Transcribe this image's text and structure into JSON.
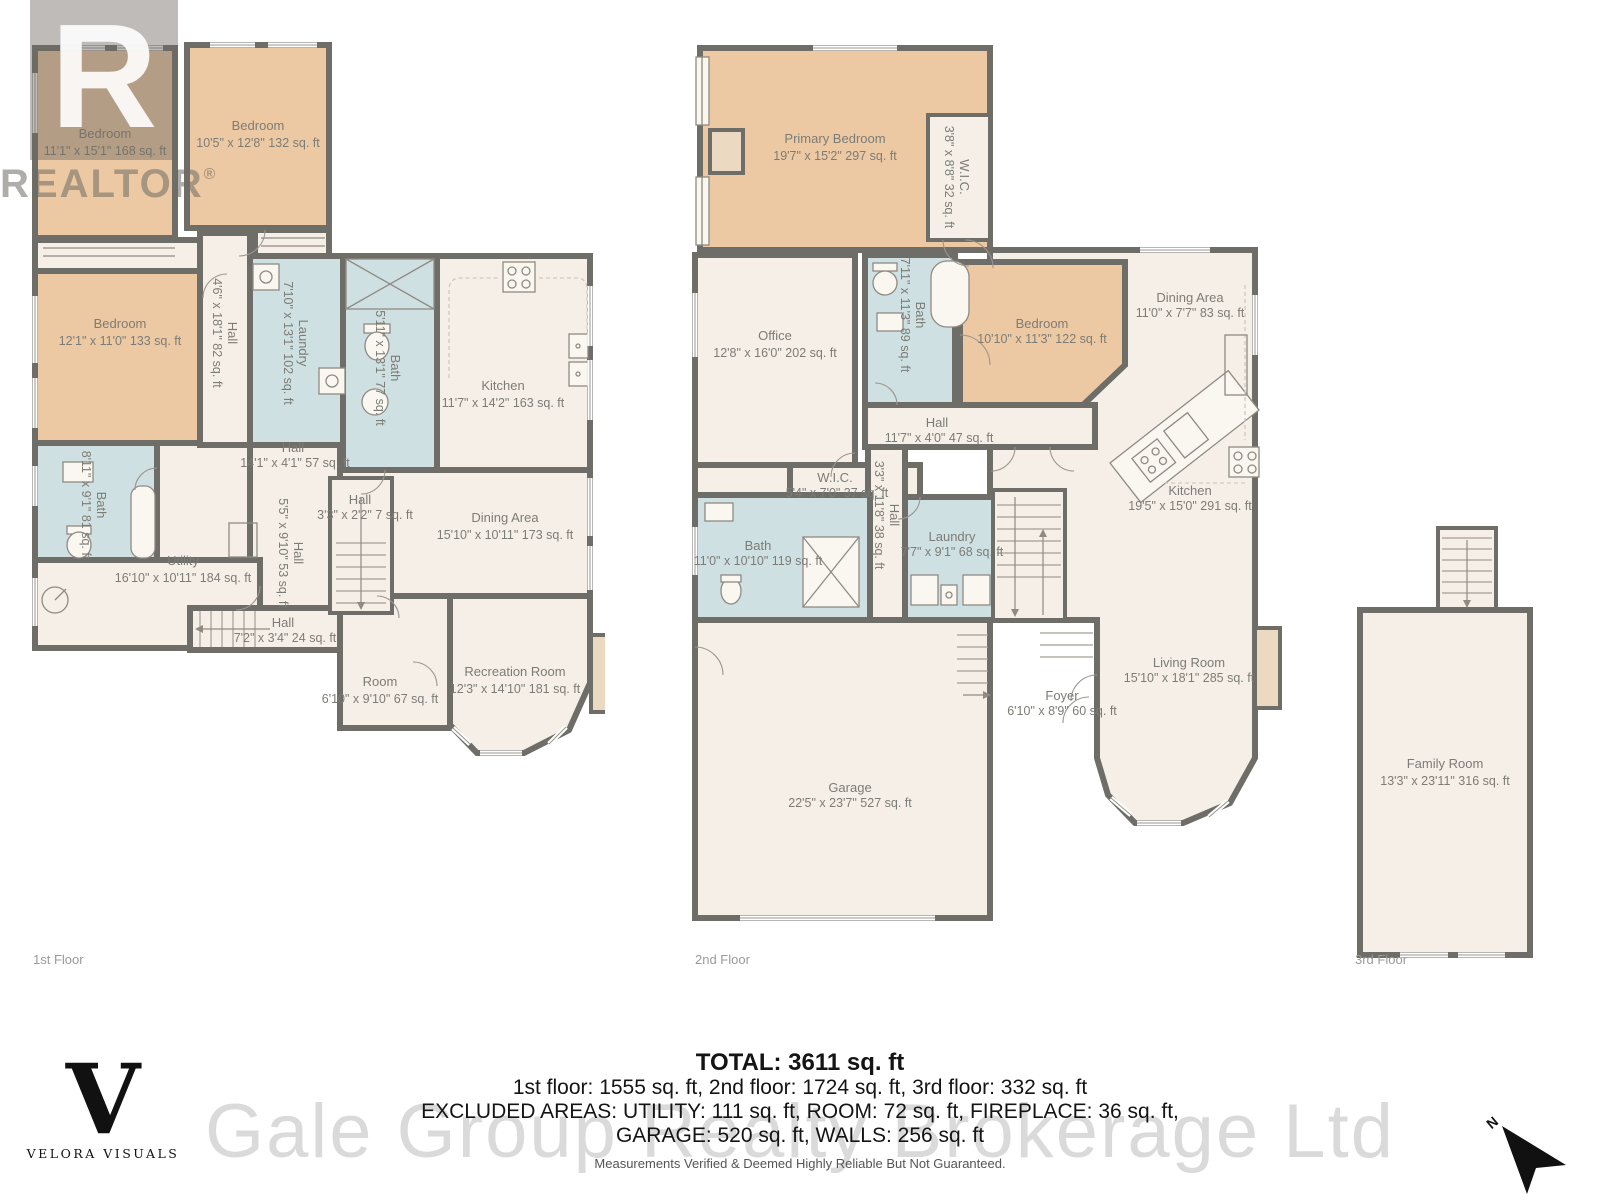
{
  "colors": {
    "bedroom": "#ecc9a3",
    "wet": "#cfe0e3",
    "floor": "#f6efe8",
    "wall": "#6e6d68",
    "label": "#7c7c76"
  },
  "branding": {
    "realtor_glyph": "R",
    "realtor_wordmark": "REALTOR",
    "realtor_reg": "®",
    "velora_initial": "V",
    "velora_name": "VELORA VISUALS",
    "compass_n": "N"
  },
  "floors": [
    {
      "label": "1st Floor",
      "rooms": [
        {
          "name": "Bedroom",
          "dims": "11'1\" x 15'1\" 168 sq. ft"
        },
        {
          "name": "Bedroom",
          "dims": "10'5\" x 12'8\" 132 sq. ft"
        },
        {
          "name": "Bedroom",
          "dims": "12'1\" x 11'0\" 133 sq. ft"
        },
        {
          "name": "Hall",
          "dims": "4'6\" x 18'1\" 82 sq. ft"
        },
        {
          "name": "Laundry",
          "dims": "7'10\" x 13'1\" 102 sq. ft"
        },
        {
          "name": "Bath",
          "dims": "5'11\" x 13'1\" 77 sq. ft"
        },
        {
          "name": "Kitchen",
          "dims": "11'7\" x 14'2\" 163 sq. ft"
        },
        {
          "name": "Bath",
          "dims": "8'11\" x 9'1\" 81 sq. ft"
        },
        {
          "name": "Hall",
          "dims": "14'1\" x 4'1\" 57 sq. ft"
        },
        {
          "name": "Utility",
          "dims": "16'10\" x 10'11\" 184 sq. ft"
        },
        {
          "name": "Hall",
          "dims": "5'5\" x 9'10\" 53 sq. ft"
        },
        {
          "name": "Hall",
          "dims": "3'3\" x 2'2\" 7 sq. ft"
        },
        {
          "name": "Hall",
          "dims": "7'2\" x 3'4\" 24 sq. ft"
        },
        {
          "name": "Room",
          "dims": "6'10\" x 9'10\" 67 sq. ft"
        },
        {
          "name": "Dining Area",
          "dims": "15'10\" x 10'11\" 173 sq. ft"
        },
        {
          "name": "Recreation Room",
          "dims": "12'3\" x 14'10\" 181 sq. ft"
        }
      ]
    },
    {
      "label": "2nd Floor",
      "rooms": [
        {
          "name": "Primary Bedroom",
          "dims": "19'7\" x 15'2\" 297 sq. ft"
        },
        {
          "name": "W.I.C.",
          "dims": "3'8\" x 8'8\" 32 sq. ft"
        },
        {
          "name": "Office",
          "dims": "12'8\" x 16'0\" 202 sq. ft"
        },
        {
          "name": "Bath",
          "dims": "7'11\" x 11'3\" 89 sq. ft"
        },
        {
          "name": "Bedroom",
          "dims": "10'10\" x 11'3\" 122 sq. ft"
        },
        {
          "name": "Dining Area",
          "dims": "11'0\" x 7'7\" 83 sq. ft"
        },
        {
          "name": "Hall",
          "dims": "11'7\" x 4'0\" 47 sq. ft"
        },
        {
          "name": "W.I.C.",
          "dims": "5'4\" x 7'0\" 37 sq. ft"
        },
        {
          "name": "Hall",
          "dims": "3'3\" x 11'8\" 38 sq. ft"
        },
        {
          "name": "Bath",
          "dims": "11'0\" x 10'10\" 119 sq. ft"
        },
        {
          "name": "Laundry",
          "dims": "7'7\" x 9'1\" 68 sq. ft"
        },
        {
          "name": "Kitchen",
          "dims": "19'5\" x 15'0\" 291 sq. ft"
        },
        {
          "name": "Garage",
          "dims": "22'5\" x 23'7\" 527 sq. ft"
        },
        {
          "name": "Foyer",
          "dims": "6'10\" x 8'9\" 60 sq. ft"
        },
        {
          "name": "Living Room",
          "dims": "15'10\" x 18'1\" 285 sq. ft"
        }
      ]
    },
    {
      "label": "3rd Floor",
      "rooms": [
        {
          "name": "Family Room",
          "dims": "13'3\" x 23'11\" 316 sq. ft"
        }
      ]
    }
  ],
  "summary": {
    "total": "TOTAL: 3611 sq. ft",
    "floors_line": "1st floor: 1555 sq. ft, 2nd floor: 1724 sq. ft, 3rd floor: 332 sq. ft",
    "excluded_line1": "EXCLUDED AREAS: UTILITY: 111 sq. ft, ROOM: 72 sq. ft, FIREPLACE: 36 sq. ft,",
    "excluded_line2": "GARAGE: 520 sq. ft, WALLS: 256 sq. ft",
    "watermark": "Gale Group Realty Brokerage Ltd",
    "disclaimer": "Measurements Verified & Deemed Highly Reliable But Not Guaranteed."
  }
}
